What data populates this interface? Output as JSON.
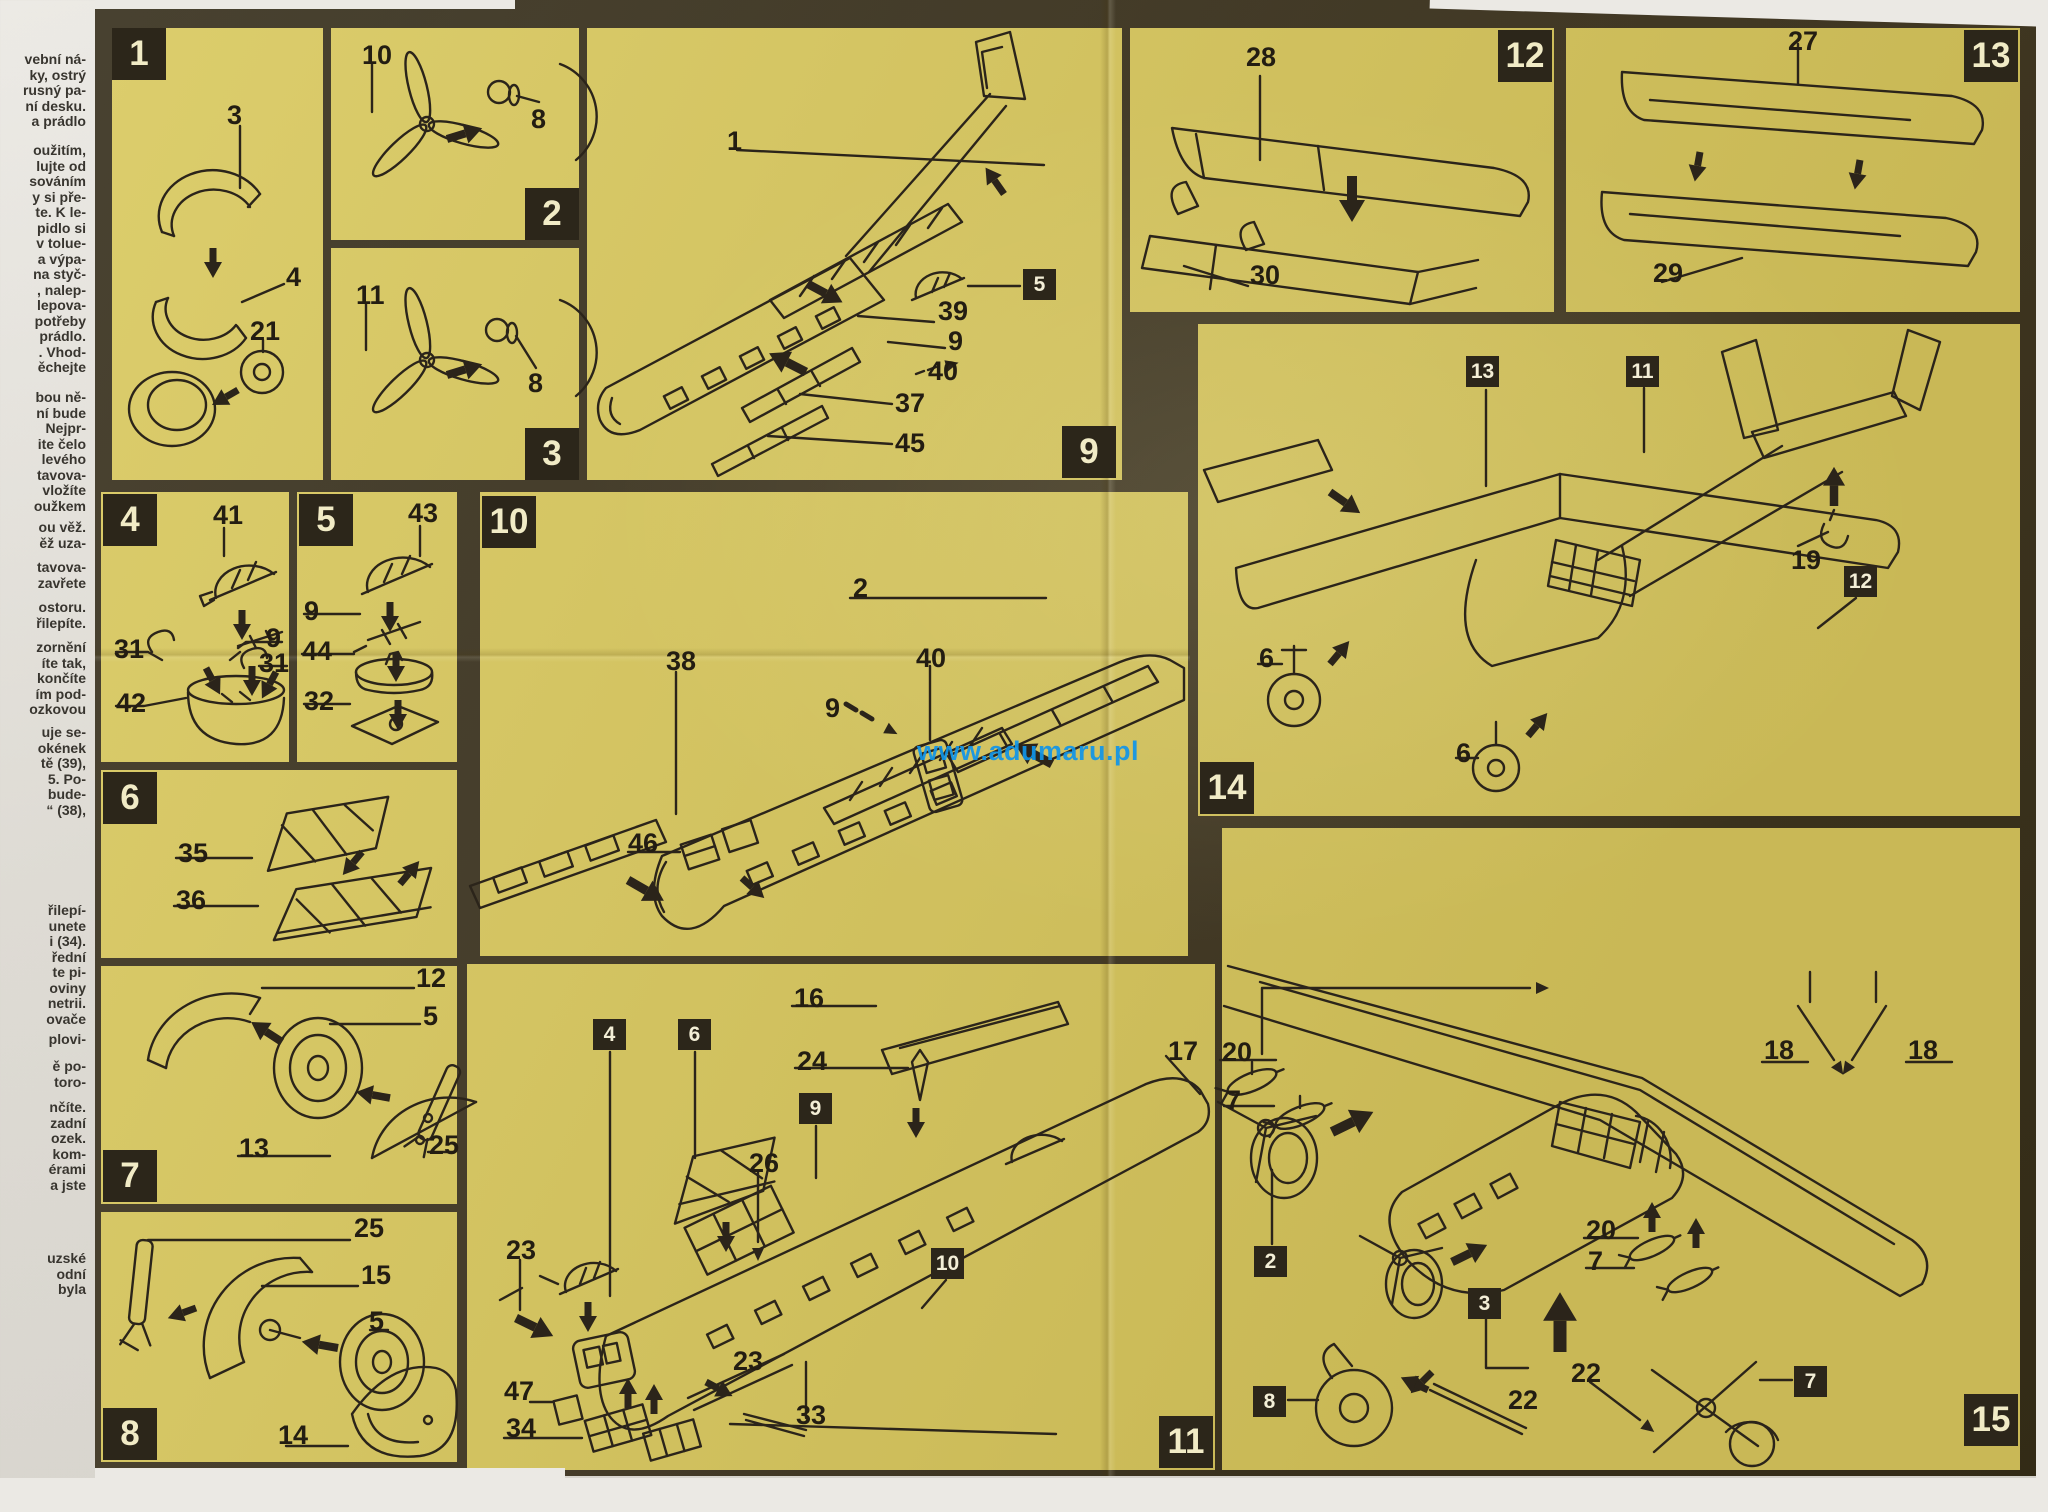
{
  "watermark": {
    "text": "www.adumaru.pl",
    "color": "#1095ea"
  },
  "colors": {
    "sheet_paper": "#d8c860",
    "border_ink": "#2c261a",
    "line_ink": "#2b241a",
    "step_number": "#f1ebc6"
  },
  "text_column": {
    "blocks": [
      {
        "top": 52,
        "lines": [
          "vební ná-",
          "ky, ostrý",
          "rusný pa-",
          "ní desku.",
          "a prádlo"
        ]
      },
      {
        "top": 143,
        "lines": [
          "oužitím,",
          "lujte od",
          "sováním",
          "y si pře-",
          "te. K le-",
          "pidlo si",
          "v tolue-",
          "a výpa-",
          "na styč-",
          ", nalep-",
          "lepova-",
          "potřeby",
          "prádlo.",
          ". Vhod-",
          "ěchejte"
        ]
      },
      {
        "top": 390,
        "lines": [
          "bou ně-",
          "ní bude",
          "Nejpr-",
          "ite čelo",
          "levého",
          "tavova-",
          "vložíte",
          "oužkem"
        ]
      },
      {
        "top": 520,
        "lines": [
          "ou věž.",
          "ěž uza-"
        ]
      },
      {
        "top": 560,
        "lines": [
          "tavova-",
          "zavřete"
        ]
      },
      {
        "top": 600,
        "lines": [
          "ostoru.",
          "řilepíte."
        ]
      },
      {
        "top": 640,
        "lines": [
          "zornění",
          "íte tak,",
          "končíte",
          "ím pod-",
          "ozkovou"
        ]
      },
      {
        "top": 725,
        "lines": [
          "uje se-",
          "okének",
          "tě (39),",
          "5. Po-",
          "bude-",
          "“ (38),"
        ]
      },
      {
        "top": 903,
        "lines": [
          "řilepí-",
          "unete",
          "i (34).",
          "řední",
          "te pi-",
          "oviny",
          "netrii.",
          "ovače"
        ]
      },
      {
        "top": 1032,
        "lines": [
          "plovi-"
        ]
      },
      {
        "top": 1059,
        "lines": [
          "ě po-",
          "toro-"
        ]
      },
      {
        "top": 1100,
        "lines": [
          "nčíte.",
          "zadní",
          "ozek.",
          "kom-",
          "érami",
          "a jste"
        ]
      },
      {
        "top": 1251,
        "lines": [
          "uzské",
          "odní",
          "byla"
        ]
      }
    ]
  },
  "panels": [
    {
      "step": "1",
      "x": 112,
      "y": 28,
      "w": 211,
      "h": 452
    },
    {
      "step": "2",
      "x": 331,
      "y": 28,
      "w": 248,
      "h": 212
    },
    {
      "step": "3",
      "x": 331,
      "y": 248,
      "w": 248,
      "h": 232
    },
    {
      "step": "9",
      "x": 587,
      "y": 28,
      "w": 535,
      "h": 452
    },
    {
      "step": "12",
      "x": 1130,
      "y": 28,
      "w": 424,
      "h": 284
    },
    {
      "step": "13",
      "x": 1566,
      "y": 28,
      "w": 454,
      "h": 284
    },
    {
      "step": "4",
      "x": 101,
      "y": 492,
      "w": 188,
      "h": 270
    },
    {
      "step": "5",
      "x": 297,
      "y": 492,
      "w": 160,
      "h": 270
    },
    {
      "step": "10",
      "x": 480,
      "y": 492,
      "w": 708,
      "h": 464
    },
    {
      "step": "6",
      "x": 101,
      "y": 770,
      "w": 356,
      "h": 188
    },
    {
      "step": "7",
      "x": 101,
      "y": 966,
      "w": 356,
      "h": 238
    },
    {
      "step": "8",
      "x": 101,
      "y": 1212,
      "w": 356,
      "h": 250
    },
    {
      "step": "11",
      "x": 467,
      "y": 964,
      "w": 748,
      "h": 506
    },
    {
      "step": "14",
      "x": 1198,
      "y": 324,
      "w": 822,
      "h": 492
    },
    {
      "step": "15",
      "x": 1222,
      "y": 828,
      "w": 798,
      "h": 642
    }
  ],
  "step_boxes": [
    {
      "n": "1",
      "x": 112,
      "y": 28
    },
    {
      "n": "2",
      "x": 525,
      "y": 188
    },
    {
      "n": "3",
      "x": 525,
      "y": 428
    },
    {
      "n": "4",
      "x": 103,
      "y": 494
    },
    {
      "n": "5",
      "x": 299,
      "y": 494
    },
    {
      "n": "6",
      "x": 103,
      "y": 772
    },
    {
      "n": "7",
      "x": 103,
      "y": 1150
    },
    {
      "n": "8",
      "x": 103,
      "y": 1408
    },
    {
      "n": "9",
      "x": 1062,
      "y": 426
    },
    {
      "n": "10",
      "x": 482,
      "y": 496
    },
    {
      "n": "11",
      "x": 1159,
      "y": 1416
    },
    {
      "n": "12",
      "x": 1498,
      "y": 30
    },
    {
      "n": "13",
      "x": 1964,
      "y": 30
    },
    {
      "n": "14",
      "x": 1200,
      "y": 762
    },
    {
      "n": "15",
      "x": 1964,
      "y": 1394
    }
  ],
  "ref_boxes": [
    {
      "n": "5",
      "x": 1023,
      "y": 269
    },
    {
      "n": "4",
      "x": 593,
      "y": 1019
    },
    {
      "n": "6",
      "x": 678,
      "y": 1019
    },
    {
      "n": "9",
      "x": 799,
      "y": 1093
    },
    {
      "n": "10",
      "x": 931,
      "y": 1248
    },
    {
      "n": "13",
      "x": 1466,
      "y": 356
    },
    {
      "n": "11",
      "x": 1626,
      "y": 356
    },
    {
      "n": "12",
      "x": 1844,
      "y": 566
    },
    {
      "n": "2",
      "x": 1254,
      "y": 1246
    },
    {
      "n": "3",
      "x": 1468,
      "y": 1288
    },
    {
      "n": "8",
      "x": 1253,
      "y": 1386
    },
    {
      "n": "7",
      "x": 1794,
      "y": 1366
    }
  ],
  "part_labels": [
    {
      "n": "3",
      "x": 227,
      "y": 100
    },
    {
      "n": "4",
      "x": 286,
      "y": 262
    },
    {
      "n": "21",
      "x": 250,
      "y": 316
    },
    {
      "n": "10",
      "x": 362,
      "y": 40
    },
    {
      "n": "8",
      "x": 531,
      "y": 104
    },
    {
      "n": "11",
      "x": 356,
      "y": 280
    },
    {
      "n": "8",
      "x": 528,
      "y": 368
    },
    {
      "n": "1",
      "x": 727,
      "y": 126
    },
    {
      "n": "39",
      "x": 938,
      "y": 296
    },
    {
      "n": "9",
      "x": 948,
      "y": 326
    },
    {
      "n": "40",
      "x": 928,
      "y": 356
    },
    {
      "n": "37",
      "x": 895,
      "y": 388
    },
    {
      "n": "45",
      "x": 895,
      "y": 428
    },
    {
      "n": "28",
      "x": 1246,
      "y": 42
    },
    {
      "n": "30",
      "x": 1250,
      "y": 260
    },
    {
      "n": "27",
      "x": 1788,
      "y": 26
    },
    {
      "n": "29",
      "x": 1653,
      "y": 258
    },
    {
      "n": "41",
      "x": 213,
      "y": 500
    },
    {
      "n": "9",
      "x": 266,
      "y": 623
    },
    {
      "n": "31",
      "x": 114,
      "y": 634
    },
    {
      "n": "31",
      "x": 259,
      "y": 648
    },
    {
      "n": "42",
      "x": 116,
      "y": 688
    },
    {
      "n": "43",
      "x": 408,
      "y": 498
    },
    {
      "n": "9",
      "x": 304,
      "y": 596
    },
    {
      "n": "44",
      "x": 302,
      "y": 636
    },
    {
      "n": "32",
      "x": 304,
      "y": 686
    },
    {
      "n": "35",
      "x": 178,
      "y": 838
    },
    {
      "n": "36",
      "x": 176,
      "y": 885
    },
    {
      "n": "12",
      "x": 416,
      "y": 963
    },
    {
      "n": "5",
      "x": 423,
      "y": 1001
    },
    {
      "n": "13",
      "x": 239,
      "y": 1133
    },
    {
      "n": "25",
      "x": 429,
      "y": 1130
    },
    {
      "n": "25",
      "x": 354,
      "y": 1213
    },
    {
      "n": "15",
      "x": 361,
      "y": 1260
    },
    {
      "n": "5",
      "x": 369,
      "y": 1306
    },
    {
      "n": "14",
      "x": 278,
      "y": 1420
    },
    {
      "n": "2",
      "x": 853,
      "y": 573
    },
    {
      "n": "38",
      "x": 666,
      "y": 646
    },
    {
      "n": "40",
      "x": 916,
      "y": 643
    },
    {
      "n": "9",
      "x": 825,
      "y": 693
    },
    {
      "n": "46",
      "x": 628,
      "y": 828
    },
    {
      "n": "16",
      "x": 794,
      "y": 983
    },
    {
      "n": "24",
      "x": 797,
      "y": 1046
    },
    {
      "n": "26",
      "x": 749,
      "y": 1148
    },
    {
      "n": "17",
      "x": 1168,
      "y": 1036
    },
    {
      "n": "23",
      "x": 506,
      "y": 1235
    },
    {
      "n": "23",
      "x": 733,
      "y": 1346
    },
    {
      "n": "47",
      "x": 504,
      "y": 1376
    },
    {
      "n": "34",
      "x": 506,
      "y": 1413
    },
    {
      "n": "33",
      "x": 796,
      "y": 1400
    },
    {
      "n": "19",
      "x": 1791,
      "y": 545
    },
    {
      "n": "6",
      "x": 1259,
      "y": 643
    },
    {
      "n": "6",
      "x": 1456,
      "y": 738
    },
    {
      "n": "20",
      "x": 1222,
      "y": 1037
    },
    {
      "n": "7",
      "x": 1226,
      "y": 1085
    },
    {
      "n": "20",
      "x": 1586,
      "y": 1215
    },
    {
      "n": "7",
      "x": 1588,
      "y": 1246
    },
    {
      "n": "22",
      "x": 1571,
      "y": 1358
    },
    {
      "n": "22",
      "x": 1508,
      "y": 1385
    },
    {
      "n": "18",
      "x": 1764,
      "y": 1035
    },
    {
      "n": "18",
      "x": 1908,
      "y": 1035
    }
  ]
}
